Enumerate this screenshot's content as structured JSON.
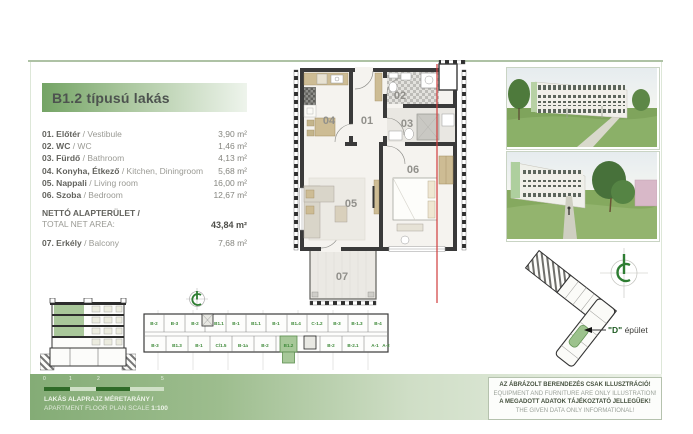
{
  "title": "B1.2 típusú lakás",
  "room_list": {
    "rows": [
      {
        "left_bold": "01. Előtér",
        "left_rest": " / Vestibule",
        "area": "3,90 m²"
      },
      {
        "left_bold": "02. WC",
        "left_rest": " / WC",
        "area": "1,46 m²"
      },
      {
        "left_bold": "03. Fürdő",
        "left_rest": " / Bathroom",
        "area": "4,13 m²"
      },
      {
        "left_bold": "04. Konyha, Étkező",
        "left_rest": " / Kitchen, Diningroom",
        "area": "5,68 m²"
      },
      {
        "left_bold": "05. Nappali",
        "left_rest": " / Living room",
        "area": "16,00 m²"
      },
      {
        "left_bold": "06. Szoba",
        "left_rest": " / Bedroom",
        "area": "12,67 m²"
      }
    ],
    "total": {
      "label_line1": "NETTÓ ALAPTERÜLET /",
      "label_line2": "TOTAL NET AREA:",
      "area": "43,84 m²"
    },
    "balcony": {
      "left_bold": "07. Erkély",
      "left_rest": " / Balcony",
      "area": "7,68 m²"
    }
  },
  "floor_plan": {
    "rooms": {
      "r01": "01",
      "r02": "02",
      "r03": "03",
      "r04": "04",
      "r05": "05",
      "r06": "06",
      "r07": "07"
    }
  },
  "strip_plan": {
    "top_units": [
      "B-2",
      "B-3",
      "B-2",
      "B1.1",
      "B-1",
      "B1.1",
      "B-1",
      "B1.4",
      "C-1.2",
      "B-3",
      "B-1.3",
      "B-4"
    ],
    "bottom_units": [
      "B-3",
      "B1.3",
      "B-1",
      "C/1.5",
      "B-1a",
      "B-2",
      "B1.2",
      "B-2",
      "B-2.1",
      "A-1",
      "A-2"
    ],
    "highlighted_unit": "B1.2"
  },
  "site_plan": {
    "label_d": "\"D\"",
    "label_rest": " épület"
  },
  "scale_bar": {
    "ticks": [
      "0",
      "1",
      "2",
      "5"
    ],
    "label_hu": "LAKÁS ALAPRAJZ MÉRETARÁNY /",
    "label_en_prefix": "APARTMENT FLOOR PLAN SCALE ",
    "label_scale": "1:100"
  },
  "disclaimer": {
    "line1": "AZ ÁBRÁZOLT BERENDEZÉS CSAK ILLUSZTRÁCIÓ!",
    "line2": "EQUIPMENT AND FURNITURE ARE ONLY ILLUSTRATION!",
    "line3": "A MEGADOTT ADATOK TÁJÉKOZTATÓ JELLEGŰEK!",
    "line4": "THE GIVEN DATA ONLY INFORMATIONAL!"
  },
  "colors": {
    "accent_green": "#4e8a3e",
    "highlight_green": "#a7c899",
    "section_red": "#d03c3c"
  }
}
